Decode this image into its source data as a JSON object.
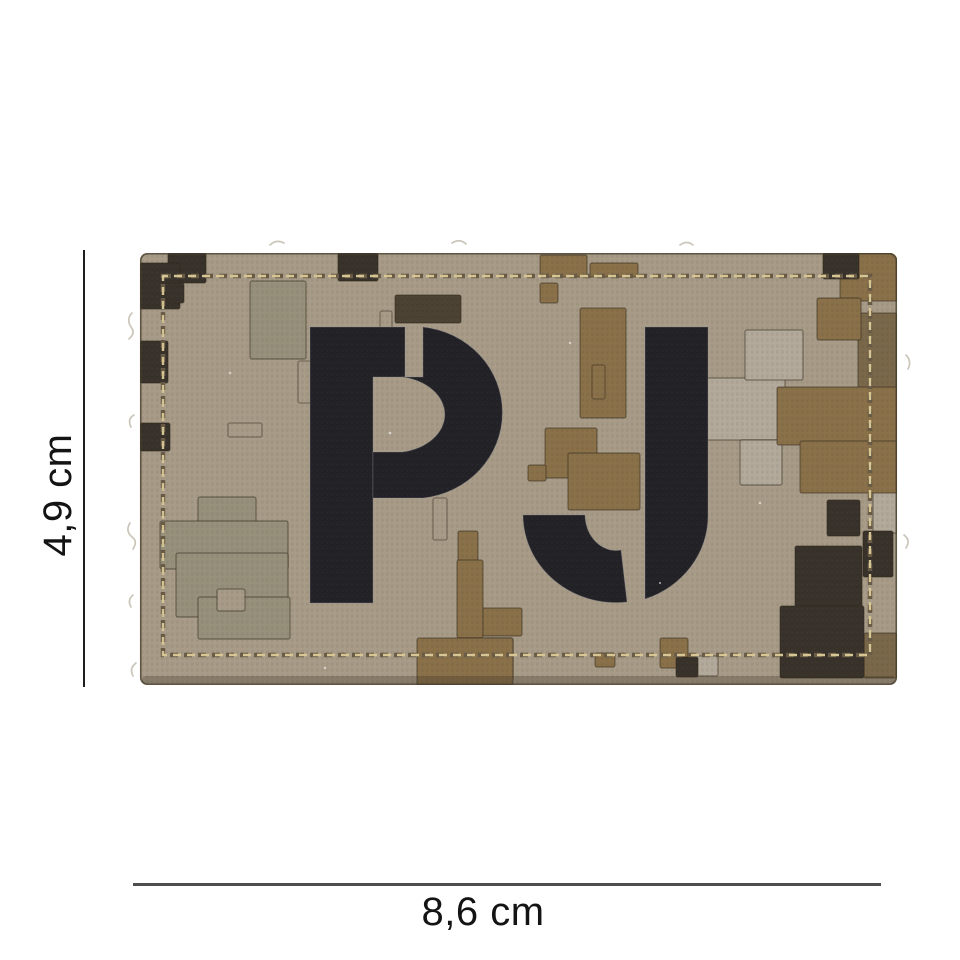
{
  "photo": {
    "description": "digital pixel camouflage PVC velcro patch with stencil letters",
    "letters_text": "PJ",
    "dimensions": {
      "height_label": "4,9 cm",
      "width_label": "8,6 cm"
    },
    "palette": {
      "base": "#a89c88",
      "light": "#b3aa9b",
      "sage": "#97917c",
      "brown": "#8a7149",
      "brown2": "#7b684a",
      "dark": "#4c4233",
      "black": "#38322b",
      "letter": "#222227",
      "stitch_light": "#d8c795",
      "stitch_dark": "#6a5c46",
      "block_outline": "rgba(50,42,28,0.5)",
      "edge_outline": "rgba(70,60,46,0.75)",
      "dim_line_v": "#1e1e1e",
      "dim_line_h": "#4e4e4e",
      "text": "#141414"
    },
    "camo_blocks": [
      {
        "x": 110,
        "y": 28,
        "w": 56,
        "h": 78,
        "c": "sage"
      },
      {
        "x": 58,
        "y": 244,
        "w": 58,
        "h": 120,
        "c": "sage"
      },
      {
        "x": 20,
        "y": 268,
        "w": 128,
        "h": 48,
        "c": "sage"
      },
      {
        "x": 36,
        "y": 300,
        "w": 112,
        "h": 64,
        "c": "sage"
      },
      {
        "x": 58,
        "y": 344,
        "w": 92,
        "h": 42,
        "c": "sage"
      },
      {
        "x": 733,
        "y": 182,
        "w": 24,
        "h": 98,
        "c": "light"
      },
      {
        "x": 343,
        "y": 385,
        "w": 30,
        "h": 42,
        "c": "light"
      },
      {
        "x": 550,
        "y": 403,
        "w": 28,
        "h": 20,
        "c": "light"
      },
      {
        "x": 560,
        "y": 125,
        "w": 85,
        "h": 62,
        "c": "light"
      },
      {
        "x": 605,
        "y": 77,
        "w": 58,
        "h": 50,
        "c": "light"
      },
      {
        "x": 600,
        "y": 187,
        "w": 42,
        "h": 45,
        "c": "light"
      },
      {
        "x": 700,
        "y": 0,
        "w": 57,
        "h": 48,
        "c": "brown"
      },
      {
        "x": 718,
        "y": 60,
        "w": 39,
        "h": 92,
        "c": "brown2"
      },
      {
        "x": 637,
        "y": 134,
        "w": 120,
        "h": 58,
        "c": "brown"
      },
      {
        "x": 660,
        "y": 188,
        "w": 97,
        "h": 52,
        "c": "brown"
      },
      {
        "x": 677,
        "y": 45,
        "w": 44,
        "h": 42,
        "c": "brown"
      },
      {
        "x": 440,
        "y": 55,
        "w": 46,
        "h": 110,
        "c": "brown"
      },
      {
        "x": 405,
        "y": 175,
        "w": 52,
        "h": 50,
        "c": "brown"
      },
      {
        "x": 428,
        "y": 200,
        "w": 72,
        "h": 57,
        "c": "brown"
      },
      {
        "x": 388,
        "y": 212,
        "w": 18,
        "h": 16,
        "c": "brown"
      },
      {
        "x": 318,
        "y": 278,
        "w": 20,
        "h": 52,
        "c": "brown"
      },
      {
        "x": 330,
        "y": 355,
        "w": 52,
        "h": 28,
        "c": "brown"
      },
      {
        "x": 317,
        "y": 307,
        "w": 26,
        "h": 78,
        "c": "brown"
      },
      {
        "x": 277,
        "y": 385,
        "w": 96,
        "h": 47,
        "c": "brown"
      },
      {
        "x": 520,
        "y": 385,
        "w": 28,
        "h": 30,
        "c": "brown"
      },
      {
        "x": 455,
        "y": 400,
        "w": 20,
        "h": 14,
        "c": "brown"
      },
      {
        "x": 400,
        "y": 2,
        "w": 47,
        "h": 22,
        "c": "brown"
      },
      {
        "x": 450,
        "y": 10,
        "w": 48,
        "h": 14,
        "c": "brown"
      },
      {
        "x": 400,
        "y": 30,
        "w": 18,
        "h": 20,
        "c": "brown"
      },
      {
        "x": 724,
        "y": 380,
        "w": 33,
        "h": 45,
        "c": "brown2"
      },
      {
        "x": 28,
        "y": 0,
        "w": 38,
        "h": 30,
        "c": "black"
      },
      {
        "x": 0,
        "y": 10,
        "w": 40,
        "h": 46,
        "c": "black"
      },
      {
        "x": 26,
        "y": 30,
        "w": 18,
        "h": 20,
        "c": "black"
      },
      {
        "x": 0,
        "y": 88,
        "w": 28,
        "h": 42,
        "c": "black"
      },
      {
        "x": 0,
        "y": 170,
        "w": 30,
        "h": 28,
        "c": "black"
      },
      {
        "x": 198,
        "y": 0,
        "w": 40,
        "h": 28,
        "c": "black"
      },
      {
        "x": 683,
        "y": 0,
        "w": 36,
        "h": 26,
        "c": "black"
      },
      {
        "x": 536,
        "y": 404,
        "w": 22,
        "h": 20,
        "c": "black"
      },
      {
        "x": 687,
        "y": 247,
        "w": 33,
        "h": 36,
        "c": "black"
      },
      {
        "x": 723,
        "y": 278,
        "w": 30,
        "h": 46,
        "c": "black"
      },
      {
        "x": 655,
        "y": 293,
        "w": 67,
        "h": 62,
        "c": "black"
      },
      {
        "x": 640,
        "y": 353,
        "w": 84,
        "h": 72,
        "c": "black"
      },
      {
        "x": 255,
        "y": 42,
        "w": 66,
        "h": 28,
        "c": "dark"
      },
      {
        "x": 77,
        "y": 336,
        "w": 28,
        "h": 22,
        "c": "base"
      }
    ],
    "emboss_rects": [
      {
        "x": 158,
        "y": 108,
        "w": 14,
        "h": 42
      },
      {
        "x": 196,
        "y": 140,
        "w": 12,
        "h": 32
      },
      {
        "x": 88,
        "y": 170,
        "w": 34,
        "h": 14
      },
      {
        "x": 293,
        "y": 245,
        "w": 14,
        "h": 42
      },
      {
        "x": 347,
        "y": 144,
        "w": 12,
        "h": 36
      },
      {
        "x": 452,
        "y": 112,
        "w": 13,
        "h": 34
      },
      {
        "x": 240,
        "y": 58,
        "w": 12,
        "h": 30
      }
    ],
    "letter_shapes": {
      "p_stem": "M170,74 L265,74 L265,124 L233,124 L233,350 L170,350 Z",
      "p_bowl": "M283,74 A89,86 0 0 1 283,245 L233,245 L233,199 L262,199 A51,38 0 0 0 262,124 L283,124 Z",
      "j_main": "M505,74 L568,74 L568,262 A93,88 0 0 1 505,346 Z",
      "j_hook": "M383,262 L445,262 A31,36 0 0 0 481,297 L487,349 A93,88 0 0 1 383,262 Z"
    }
  }
}
